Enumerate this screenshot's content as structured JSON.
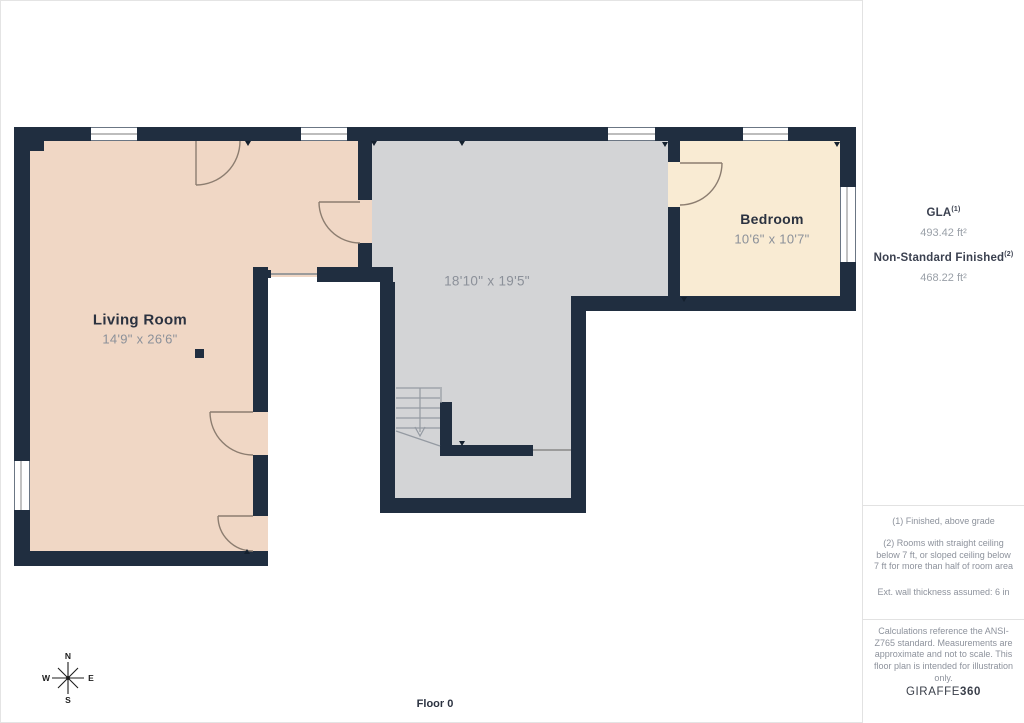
{
  "floor_label": "Floor 0",
  "rooms": [
    {
      "name": "Living Room",
      "dims": "14'9\" x 26'6\""
    },
    {
      "name": "",
      "dims": "18'10\" x 19'5\""
    },
    {
      "name": "Bedroom",
      "dims": "10'6\" x 10'7\""
    }
  ],
  "compass": {
    "n": "N",
    "e": "E",
    "s": "S",
    "w": "W"
  },
  "sidebar": {
    "gla_label": "GLA",
    "gla_sup": "(1)",
    "gla_value": "493.42 ft²",
    "nsf_label": "Non-Standard Finished",
    "nsf_sup": "(2)",
    "nsf_value": "468.22 ft²",
    "footnote1": "(1) Finished, above grade",
    "footnote2": "(2) Rooms with straight ceiling below 7 ft, or sloped ceiling below 7 ft for more than half of room area",
    "footnote3": "Ext. wall thickness assumed: 6 in",
    "disclaimer": "Calculations reference the ANSI-Z765 standard. Measurements are approximate and not to scale. This floor plan is intended for illustration only.",
    "logo_text": "GIRAFFE",
    "logo_360": "360"
  },
  "colors": {
    "wall": "#202e40",
    "living_room_floor": "#f0d7c5",
    "bedroom_floor": "#f9ebd3",
    "unfinished_floor": "#d3d4d6",
    "door_line": "#8c7d70"
  }
}
